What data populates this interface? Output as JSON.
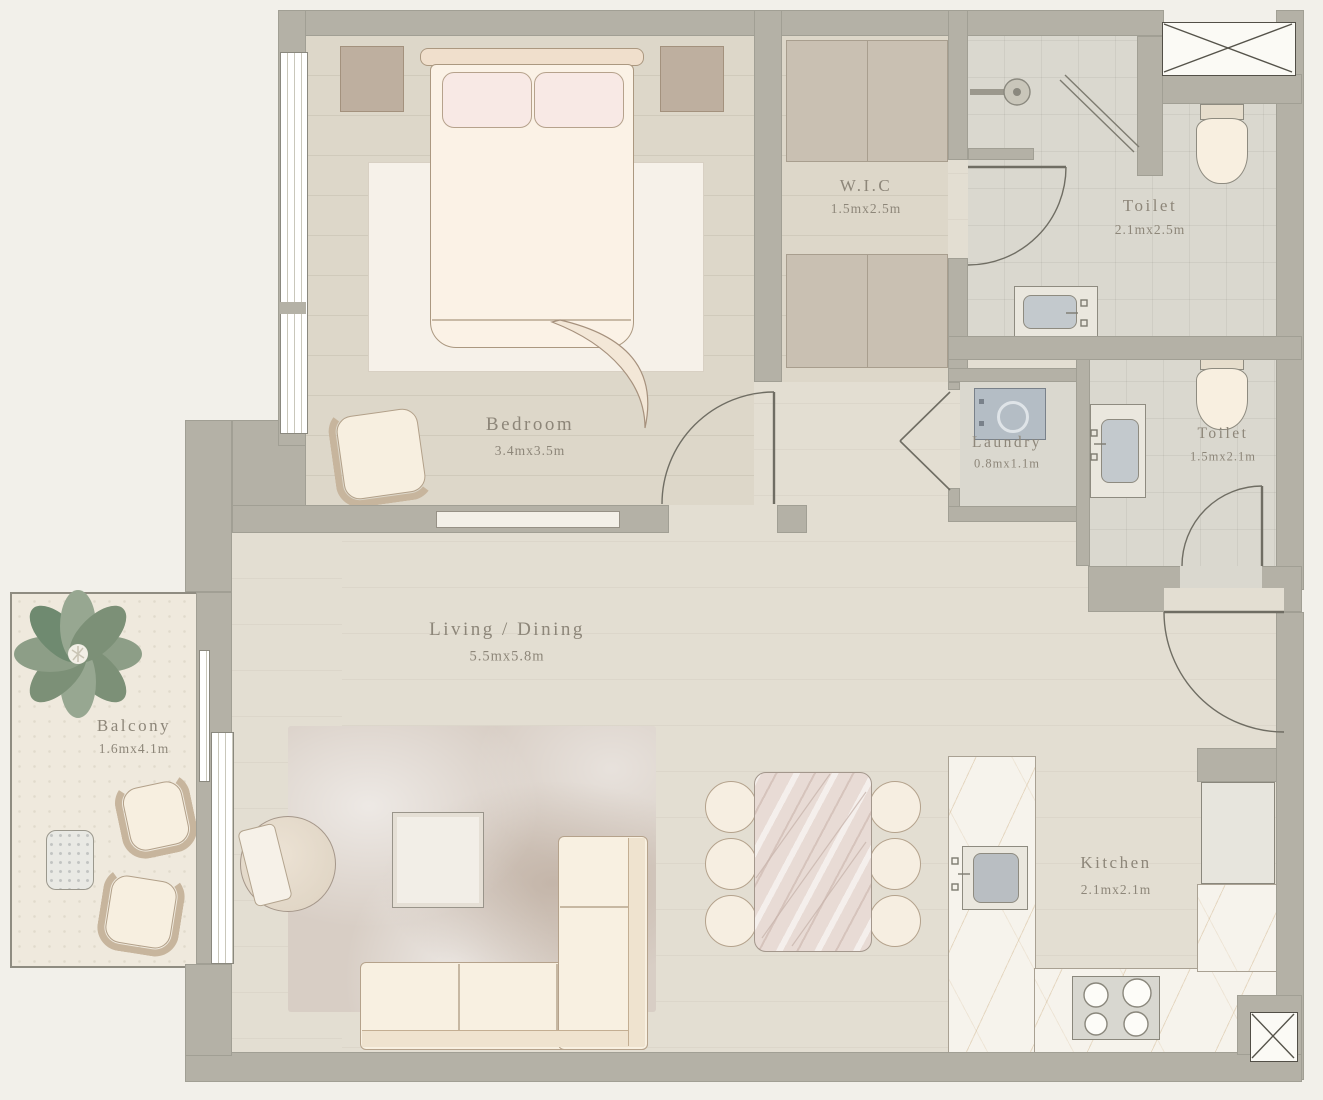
{
  "plan": {
    "type": "apartment-floor-plan",
    "rooms": [
      {
        "id": "bedroom",
        "name": "Bedroom",
        "dims": "3.4mx3.5m"
      },
      {
        "id": "wic",
        "name": "W.I.C",
        "dims": "1.5mx2.5m"
      },
      {
        "id": "toilet_top",
        "name": "Toilet",
        "dims": "2.1mx2.5m"
      },
      {
        "id": "laundry",
        "name": "Laundry",
        "dims": "0.8mx1.1m"
      },
      {
        "id": "toilet_right",
        "name": "Toilet",
        "dims": "1.5mx2.1m"
      },
      {
        "id": "living",
        "name": "Living / Dining",
        "dims": "5.5mx5.8m"
      },
      {
        "id": "balcony",
        "name": "Balcony",
        "dims": "1.6mx4.1m"
      },
      {
        "id": "kitchen",
        "name": "Kitchen",
        "dims": "2.1mx2.1m"
      }
    ],
    "fixtures": [
      "double-bed",
      "nightstands",
      "wardrobe-closets",
      "shower",
      "toilet",
      "vanity-sink",
      "washing-machine",
      "sofa",
      "dining-table-6-chairs",
      "coffee-table",
      "armchair",
      "kitchen-sink",
      "stove-4-burner",
      "refrigerator",
      "balcony-plant",
      "balcony-chairs",
      "side-table",
      "service-shafts"
    ],
    "colors": {
      "page_background": "#f2f0ea",
      "wall": "#b4b1a6",
      "floor_main": "#e3ded2",
      "floor_wood": "#ddd7c9",
      "floor_tile": "#dad8cf",
      "closet": "#c9c0b2",
      "furniture_cream": "#f7efe0",
      "marble_counter": "#f6f3ec",
      "marble_vein_gold": "#ba9258",
      "washer_blue": "#b4bdc5",
      "plant_green": "#85977f",
      "label_text": "#8d8679"
    }
  }
}
